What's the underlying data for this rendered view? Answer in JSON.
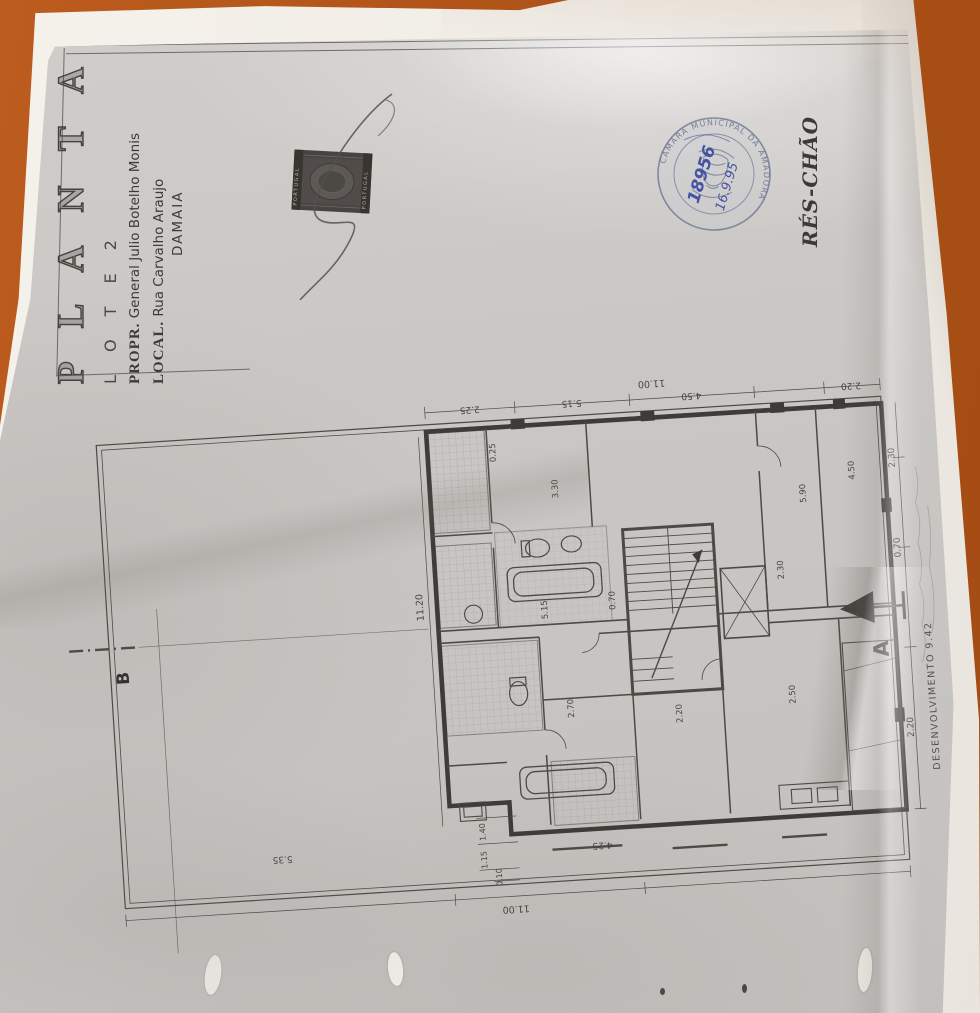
{
  "photo": {
    "wood_color": "#b05318",
    "paper_color": "#f2eee8",
    "scan_color": "#c9c6c3"
  },
  "title_block": {
    "title": "P L A N T A S",
    "lot": "L O T E   2",
    "propr_label": "PROPR.",
    "propr_value": "General Julio Botelho Monis",
    "local_label": "LOCAL.",
    "local_value": "Rua  Carvalho   Araujo",
    "local_value_line2": "DAMAIA"
  },
  "stamps": {
    "municipal": {
      "ring_text": "CÂMARA MUNICIPAL DA AMADORA",
      "handwritten_number": "18956",
      "handwritten_date": "16.9.95",
      "ink_color": "#4553a4",
      "ring_color": "#8189a0"
    },
    "fiscal": {
      "side_text": "PORTUGAL",
      "color": "#45413d"
    }
  },
  "annotations": {
    "floor_label": "RÉS-CHÃO",
    "development_label": "DESENVOLVIMENTO   9.42",
    "section_a": "A",
    "section_b": "B"
  },
  "plan": {
    "overall_top": "11.00",
    "overall_bottom": "11.00",
    "interior_height": "11.20",
    "top_chain": [
      "2.25",
      "5.15",
      "4.50",
      "2.20"
    ],
    "bottom_chain": [
      "5.35",
      "4.25",
      "1.40",
      "1.15",
      "0.10"
    ],
    "right_chain": [
      "2.30",
      "0.70",
      "2.20"
    ],
    "interior_dims": [
      "3.30",
      "0.25",
      "0.70",
      "2.50",
      "2.70",
      "5.90",
      "2.30",
      "4.50",
      "5.15",
      "2.20"
    ]
  }
}
